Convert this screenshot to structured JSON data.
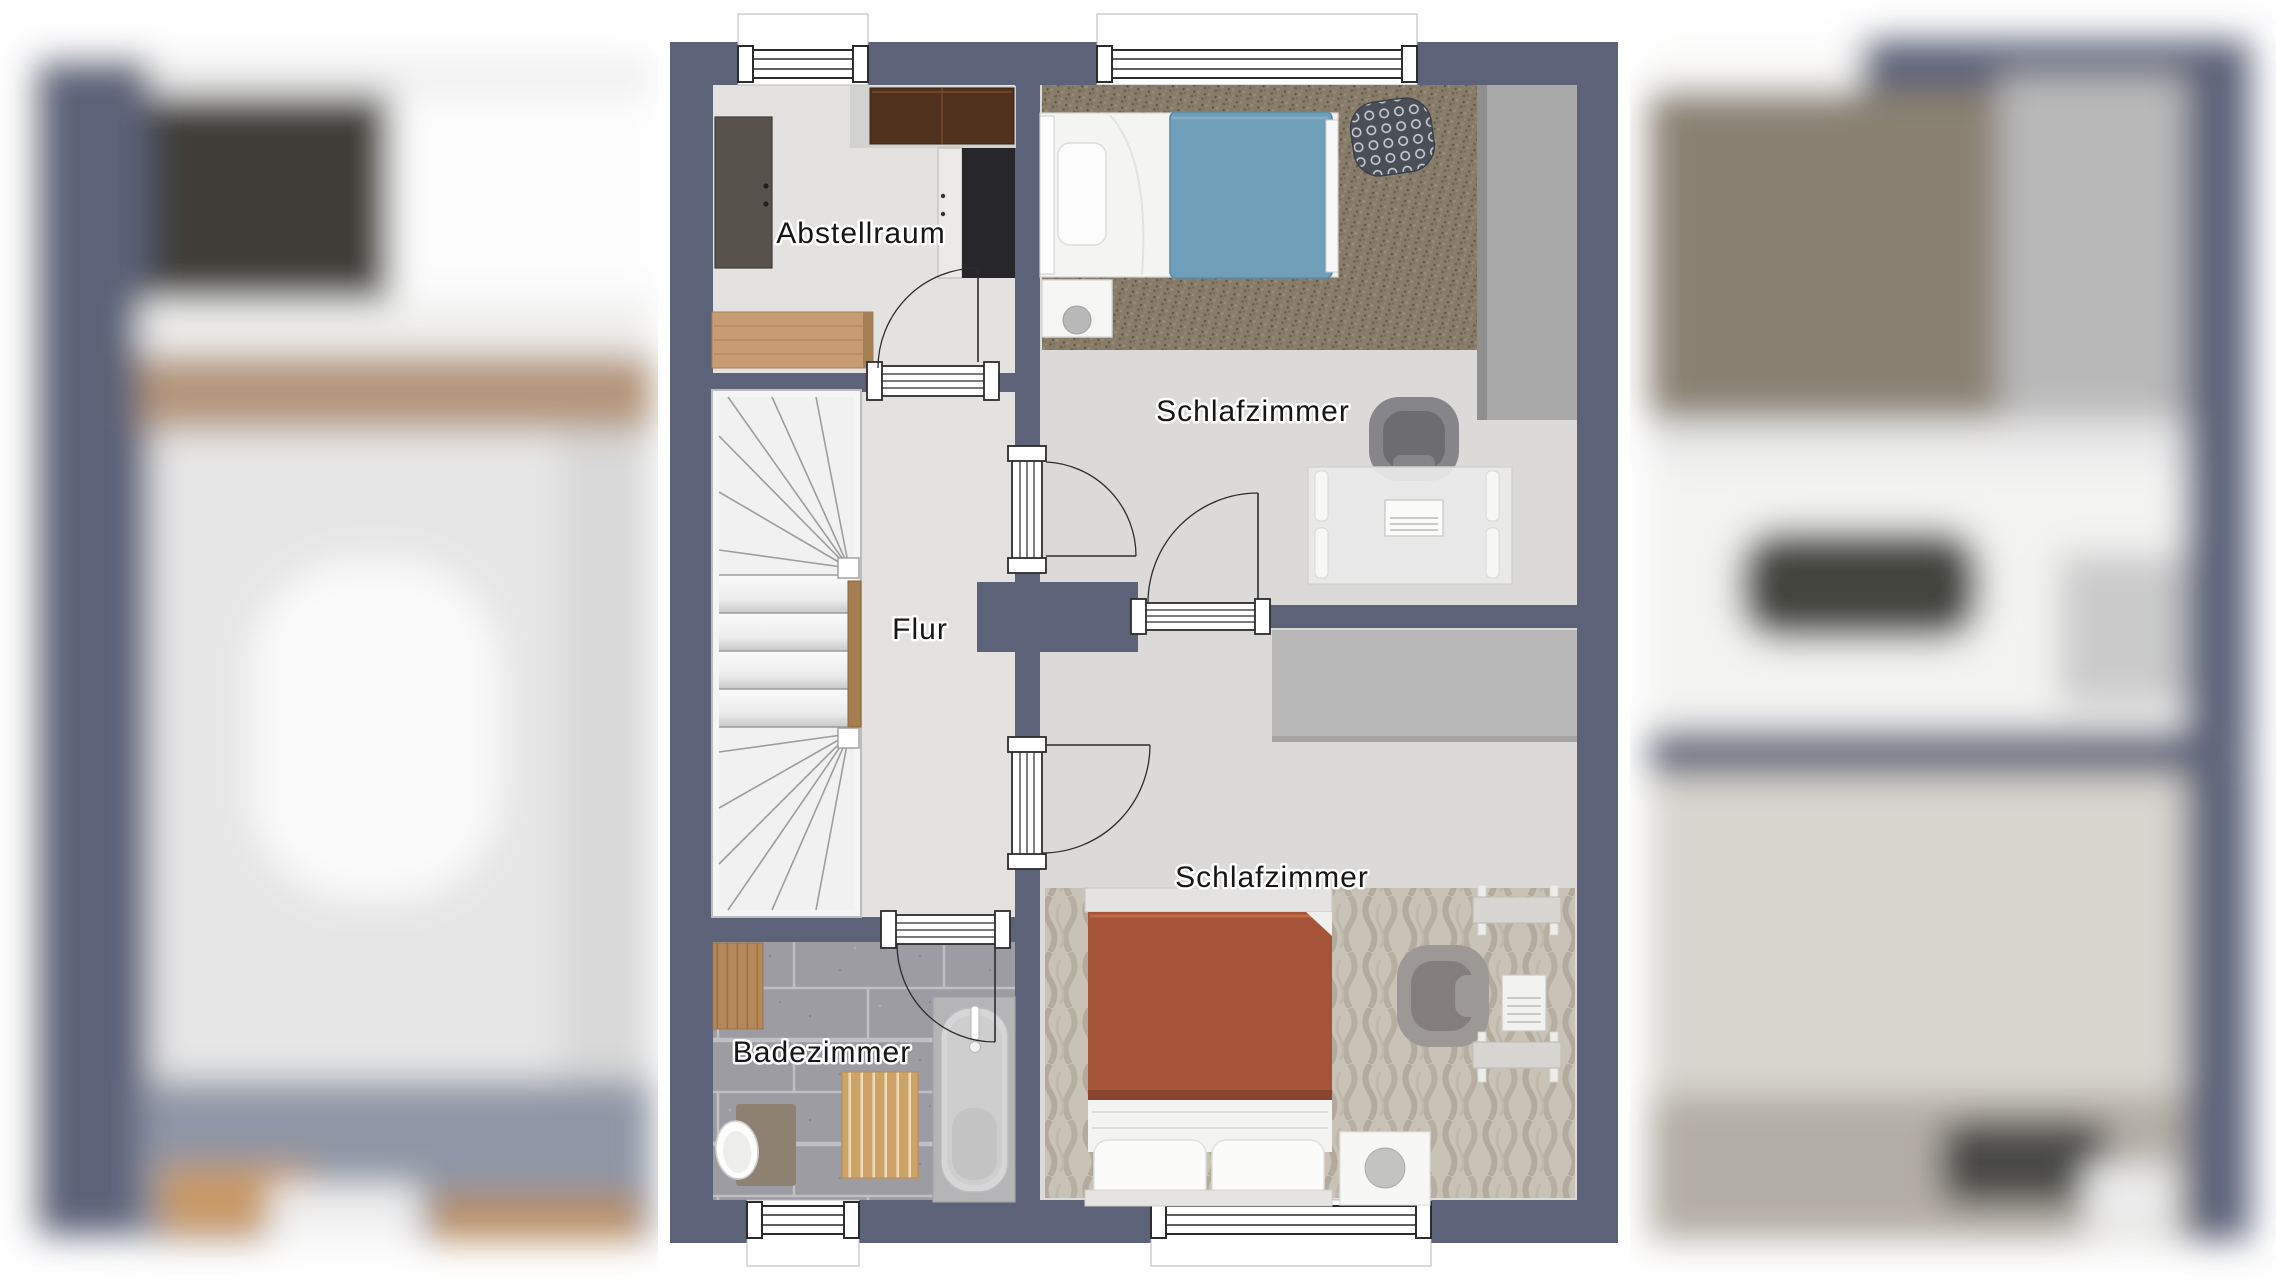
{
  "floorplan": {
    "rooms": [
      {
        "id": "abstellraum",
        "label": "Abstellraum"
      },
      {
        "id": "schlafzimmer_top",
        "label": "Schlafzimmer"
      },
      {
        "id": "flur",
        "label": "Flur"
      },
      {
        "id": "schlafzimmer_bottom",
        "label": "Schlafzimmer"
      },
      {
        "id": "badezimmer",
        "label": "Badezimmer"
      }
    ],
    "colors": {
      "wall": "#5c6278",
      "floor_light": "#e3e2e0",
      "floor_bedroom": "#dbdad8",
      "bed_blue": "#6f9eb9",
      "bed_rust": "#a5543a",
      "rug_shag_brown": "#877b69",
      "rug_knit_beige": "#c9c3b7",
      "bath_tile": "#9c9ca2",
      "wood_tan": "#c59c73",
      "wardrobe_gray": "#a9a9a9"
    }
  }
}
